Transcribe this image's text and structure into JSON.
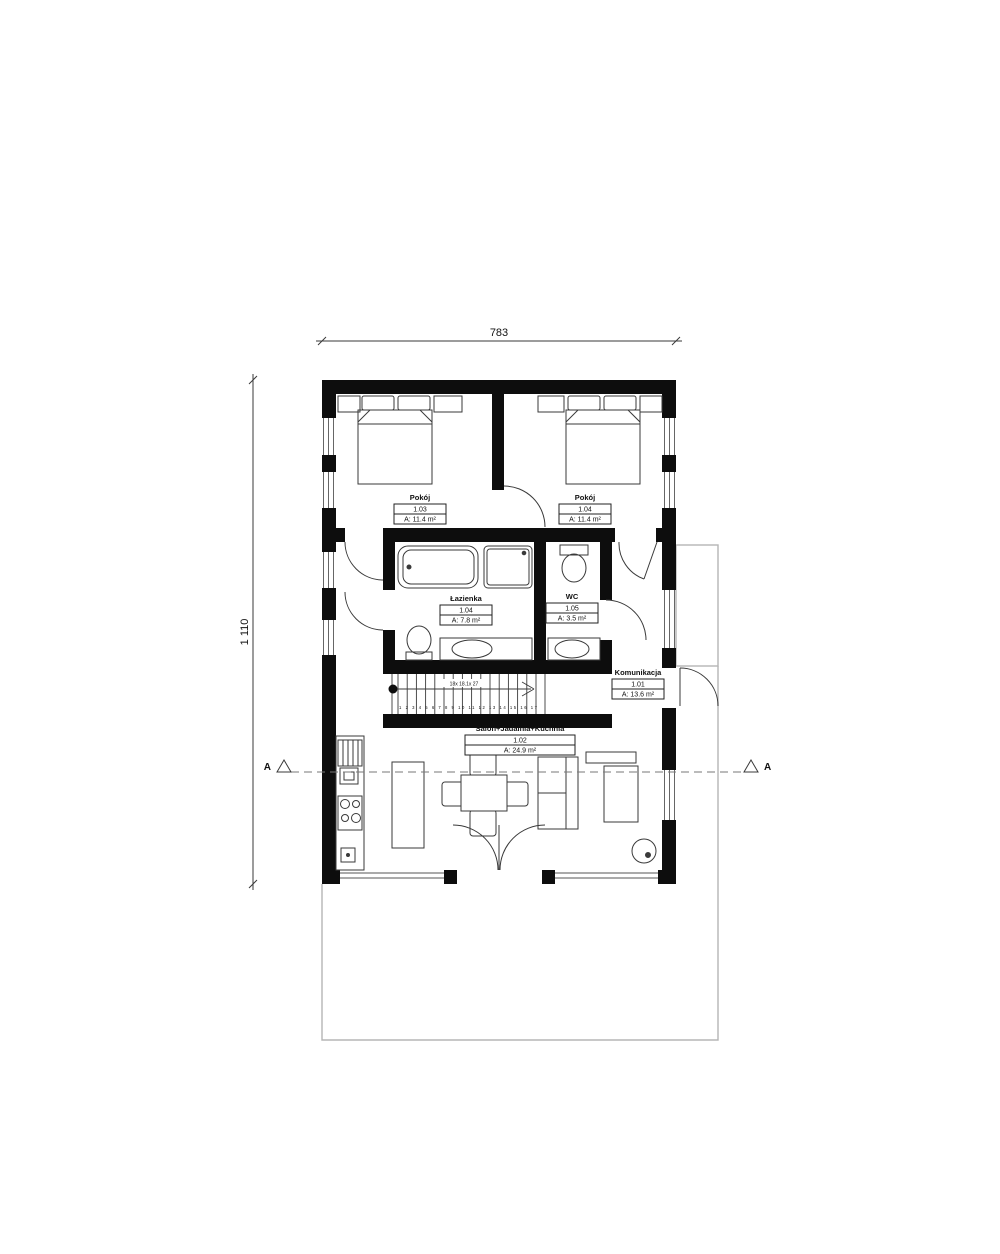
{
  "drawing": {
    "dimensions": {
      "width_label": "783",
      "height_label": "1 110"
    },
    "section_markers": {
      "left": "A",
      "right": "A"
    },
    "rooms": [
      {
        "name": "Pokój",
        "number": "1.03",
        "area": "A: 11.4 m²"
      },
      {
        "name": "Pokój",
        "number": "1.04",
        "area": "A: 11.4 m²"
      },
      {
        "name": "Łazienka",
        "number": "1.04",
        "area": "A: 7.8 m²"
      },
      {
        "name": "WC",
        "number": "1.05",
        "area": "A: 3.5 m²"
      },
      {
        "name": "Komunikacja",
        "number": "1.01",
        "area": "A: 13.6 m²"
      },
      {
        "name": "Salon+Jadalnia+Kuchnia",
        "number": "1.02",
        "area": "A: 24.9 m²"
      }
    ],
    "stairs": {
      "notation": "18x 18.1x 27",
      "step_numbers": "1 2 3 4 5 6 7 8 9 10 11 12 13 14 15 16 17"
    },
    "colors": {
      "wall": "#0d0d0d",
      "line": "#3a3a3a",
      "terrace": "#b5b5b5"
    }
  }
}
